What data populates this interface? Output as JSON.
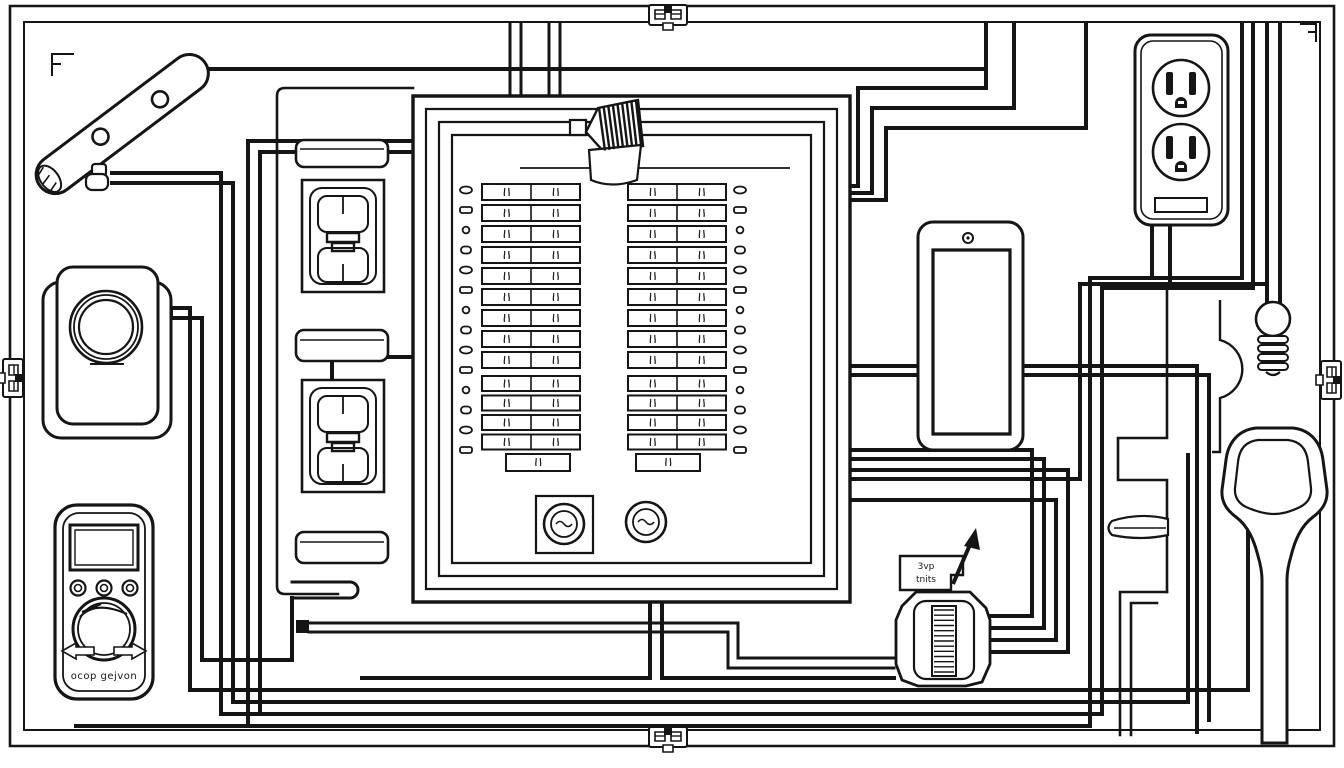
{
  "meta": {
    "description": "Black and white line-art wiring diagram of a residential circuit breaker panel connected to tools, switches, an outlet, a lamp and a GFCI device",
    "ink_color": "#151515",
    "paper_color": "#ffffff"
  },
  "labels": {
    "multimeter_text": "ocop gejvon",
    "gfci_tab_line1": "3vp",
    "gfci_tab_line2": "tnits"
  },
  "panel": {
    "columns": [
      {
        "id": "left",
        "top_rows": 9,
        "mid_rows": 4,
        "single_rows": 1,
        "terminal_blobs": 14
      },
      {
        "id": "right",
        "top_rows": 9,
        "mid_rows": 4,
        "single_rows": 1,
        "terminal_blobs": 14
      }
    ],
    "dial_count": 2,
    "feed_wire_count": 2
  },
  "gfci": {
    "stripe_count": 13
  },
  "cable_clamp": {
    "stripe_count": 9
  },
  "light_bulb": {
    "base_stripe_count": 4
  },
  "outlet": {
    "receptacle_count": 2
  },
  "multimeter": {
    "jack_count": 3
  },
  "border": {
    "ornament_positions": [
      "top-center",
      "bottom-center",
      "left-center",
      "right-center"
    ]
  }
}
